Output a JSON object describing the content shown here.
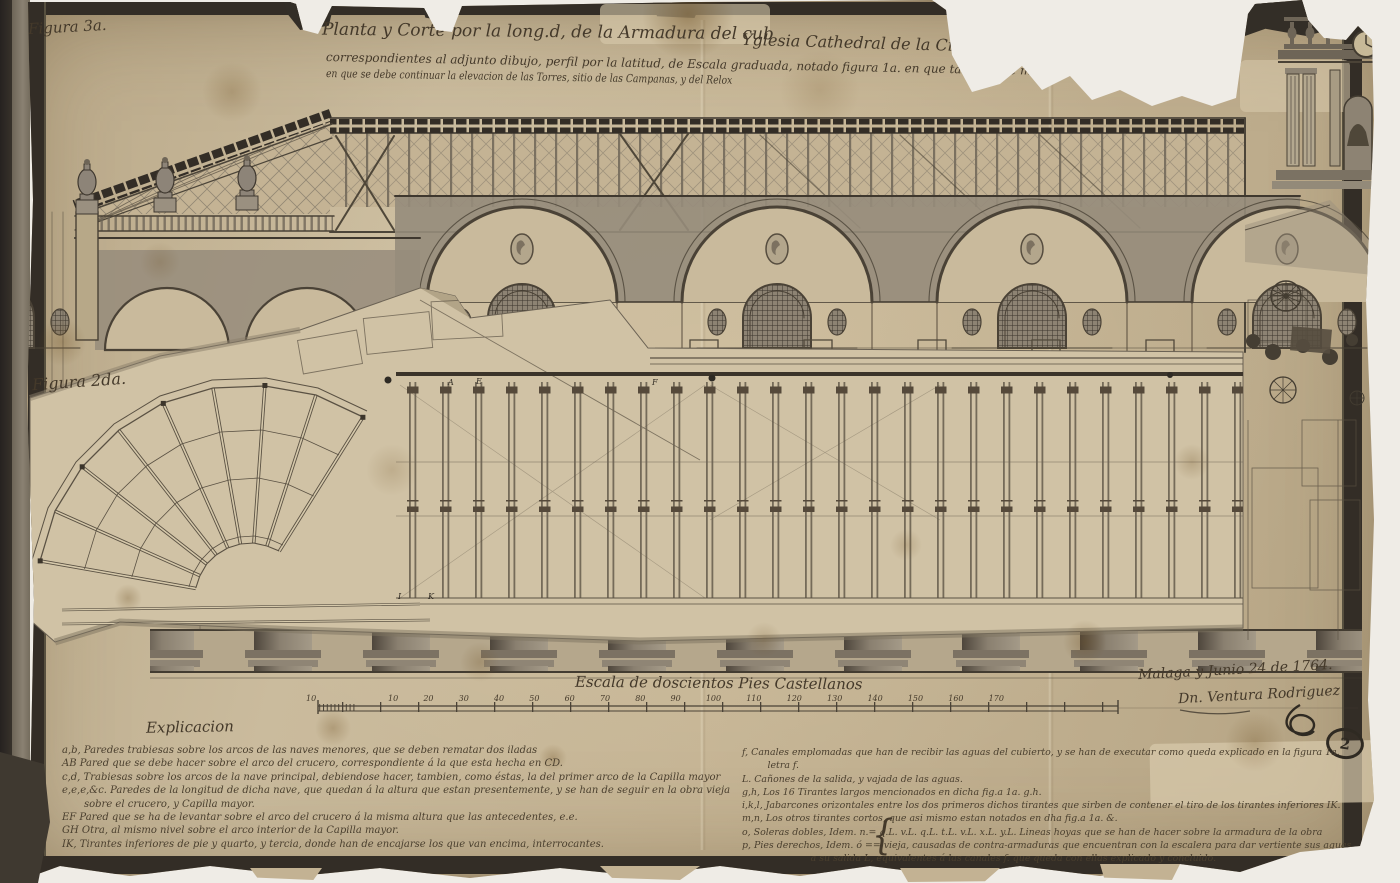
{
  "figures": {
    "fig3_label": "Figura 3a.",
    "fig2_label": "Figura 2da."
  },
  "title": {
    "line1_left": "Planta y Corte por la long.d, de la Armadura del cub",
    "line1_right": "Yglesia Cathedral de la Ciudad de M",
    "line2": "correspondientes al adjunto dibujo, perfil por la latitud, de Escala graduada, notado figura 1a. en que tambien se muestra la forma",
    "line3": "en que se debe continuar la elevacion de las Torres, sitio de las Campanas, y del Relox"
  },
  "scale_bar": {
    "caption": "Escala de doscientos Pies Castellanos",
    "lead_label": "10",
    "tick_labels": [
      "10",
      "20",
      "30",
      "40",
      "50",
      "60",
      "70",
      "80",
      "90",
      "100",
      "110",
      "120",
      "130",
      "140",
      "150",
      "160",
      "170"
    ]
  },
  "signature": {
    "place_date": "Malaga y Junio 24 de 1764.",
    "name": "Dn. Ventura Rodriguez"
  },
  "stamp_number": "2",
  "legend_left": {
    "heading": "Explicacion",
    "lines": [
      "a,b, Paredes trabiesas sobre los arcos de las naves menores, que se deben rematar dos iladas",
      "AB Pared que se debe hacer sobre el arco del crucero, correspondiente á la que esta hecha en CD.",
      "c,d, Trabiesas sobre los arcos de la nave principal, debiendose hacer, tambien, como éstas, la del primer arco de la Capilla mayor",
      "e,e,e,&c. Paredes de la longitud de dicha nave, que quedan á la altura que estan presentemente, y se han de seguir en la obra vieja",
      "sobre el crucero, y Capilla mayor.",
      "EF Pared que se ha de levantar sobre el arco del crucero á la misma altura que las antecedentes, e.e.",
      "GH Otra, al mismo nivel sobre el arco interior de la Capilla mayor.",
      "IK, Tirantes inferiores de pie y quarto, y tercia, donde han de encajarse los que van encima, interrocantes."
    ]
  },
  "legend_right": {
    "lines": [
      "f, Canales emplomadas que han de recibir las aguas del cubierto, y se han de executar como queda explicado en la figura 1a.",
      "letra f.",
      "L. Cañones de la salida, y vajada de las aguas.",
      "g,h, Los 16 Tirantes largos mencionados en dicha fig.a 1a. g.h.",
      "i,k,l, Jabarcones orizontales entre los dos primeros dichos tirantes que sirben de contener el tiro de los tirantes inferiores IK.",
      "m,n, Los otros tirantes cortos, que asi mismo estan notados en dha fig.a 1a. &.",
      "o, Soleras dobles, Idem. n.= q.L. v.L. q.L. t.L. v.L. x.L. y.L. Lineas hoyas que se han de hacer sobre la armadura de la obra",
      "p, Pies derechos, Idem. ó == vieja, causadas de contra-armaduras que encuentran con la escalera para dar vertiente sus aguas",
      "a su salida L, equivalentes á las canales f. que queda con ellas explicado y concluido."
    ]
  },
  "plan_letters": {
    "a": "A",
    "e": "E",
    "f": "F",
    "i": "I",
    "k": "K"
  },
  "brace_glyph": "{",
  "colors": {
    "paper": "#c6b595",
    "flap_paper": "#d0c2a5",
    "ink": "#44392a",
    "frame": "#332d26",
    "wash": "#968c7b",
    "backing": "#efece6"
  }
}
